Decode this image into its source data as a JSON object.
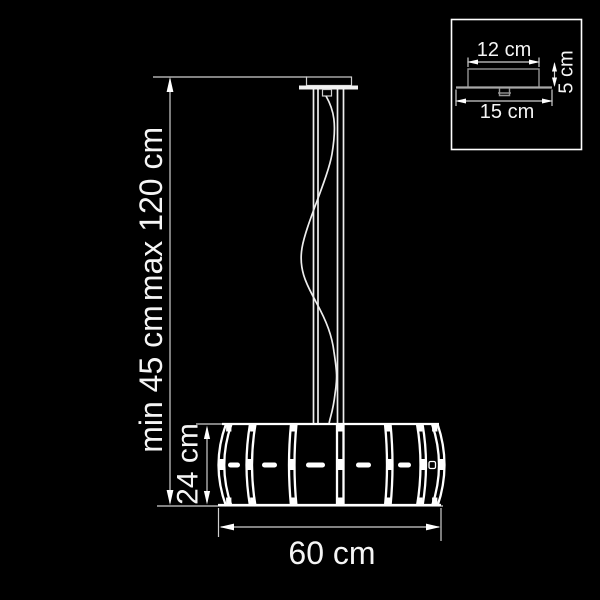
{
  "diagram": {
    "type": "pendant-lamp-dimension-drawing",
    "colors": {
      "background": "#000000",
      "line": "#ffffff",
      "thin_line": "#cfcfcf",
      "detail_gray": "#959595"
    },
    "main_dimensions": {
      "max_drop": "max 120 cm",
      "min_drop": "min 45 cm",
      "shade_height": "24 cm",
      "shade_width": "60 cm"
    },
    "inset_dimensions": {
      "canopy_width": "12 cm",
      "base_width": "15 cm",
      "canopy_height": "5 cm"
    }
  }
}
